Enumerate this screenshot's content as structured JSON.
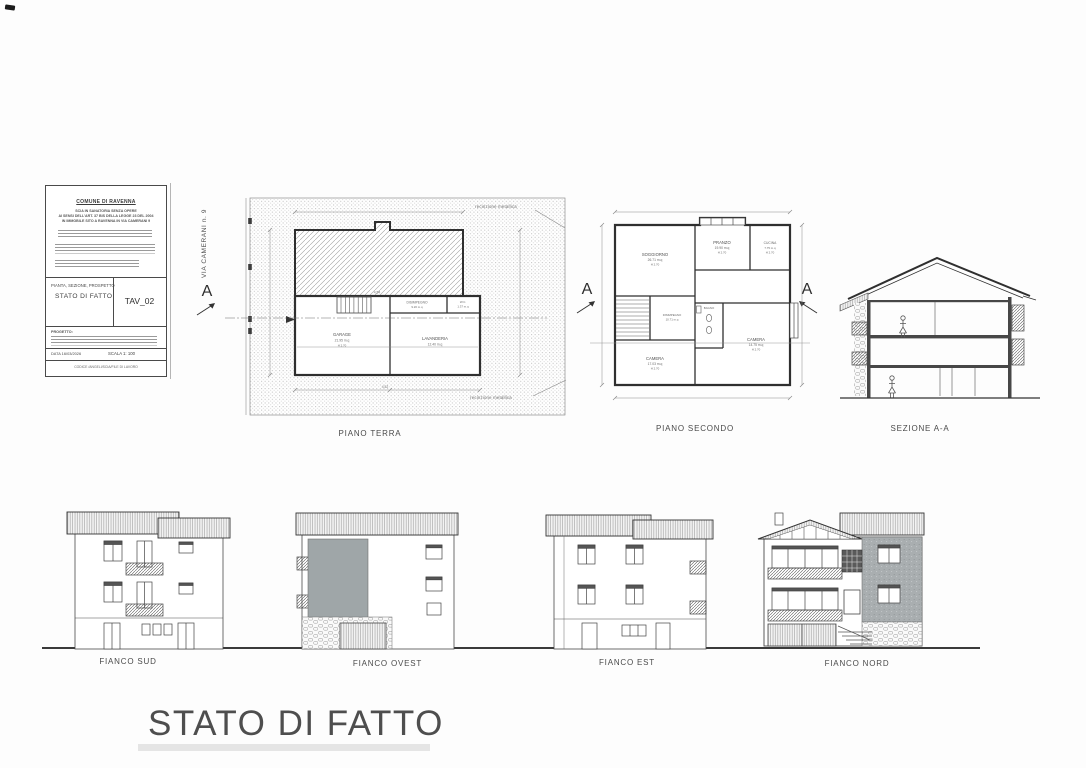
{
  "sheet": {
    "main_title": "STATO DI FATTO",
    "street_label": "VIA CAMERANI n. 9"
  },
  "title_block": {
    "comune": "COMUNE DI RAVENNA",
    "object_lines": [
      "SCIA IN SANATORIA SENZA OPERE",
      "AI SENSI DELL'ART. 37 BIS DELLA LEGGE 23 DEL 2004",
      "IN IMMOBILE SITO A RAVENNA IN VIA CAMERANI 9"
    ],
    "content_label": "PIANTA, SEZIONE, PROSPETTO",
    "content_title": "STATO DI FATTO",
    "tav": "TAV_02",
    "progetto_label": "PROGETTO:",
    "data_line": "DATA 16/03/2026",
    "scala_line": "SCALA 1: 100",
    "codice_line": "CODICE /ANGELI/SCIA/FILE DI LAVORO"
  },
  "markers": {
    "section_letter": "A"
  },
  "piano_terra": {
    "label": "PIANO TERRA",
    "fence_top": "recinzione metallica",
    "fence_bottom": "recinzione metallica",
    "rooms": {
      "garage": {
        "name": "GARAGE",
        "area": "21.95 m.q"
      },
      "lavanderia": {
        "name": "LAVANDERIA",
        "area": "12.40 m.q"
      },
      "disimpegno": {
        "name": "DISIMPEGNO",
        "area": "9.20 m.q"
      },
      "wc": {
        "name": "W.C.",
        "area": "1.37 m.q"
      }
    },
    "dims": {
      "d1": "4.54",
      "d2": "4.52",
      "h": "H 2.70"
    }
  },
  "piano_secondo": {
    "label": "PIANO SECONDO",
    "rooms": {
      "soggiorno": {
        "name": "SOGGIORNO",
        "area": "26.71 m.q",
        "h": "H 2.70"
      },
      "pranzo": {
        "name": "PRANZO",
        "area": "19.90 m.q",
        "h": "H 2.70"
      },
      "cucina": {
        "name": "CUCINA",
        "area": "7.75 m.q",
        "h": "H 2.70"
      },
      "camera1": {
        "name": "CAMERA",
        "area": "17.03 m.q",
        "h": "H 2.70"
      },
      "camera2": {
        "name": "CAMERA",
        "area": "14.75 m.q",
        "h": "H 2.70"
      },
      "bagno": {
        "name": "BAGNO"
      },
      "disimpegno": {
        "name": "DISIMPEGNO",
        "area": "10.71 m.q"
      }
    }
  },
  "sezione": {
    "label": "SEZIONE A-A"
  },
  "elevations": {
    "sud": {
      "label": "FIANCO SUD"
    },
    "ovest": {
      "label": "FIANCO OVEST"
    },
    "est": {
      "label": "FIANCO EST"
    },
    "nord": {
      "label": "FIANCO NORD"
    }
  },
  "colors": {
    "ink": "#3a3a3a",
    "paper": "#fdfdfd",
    "gray_panel": "#9fa6a8"
  }
}
